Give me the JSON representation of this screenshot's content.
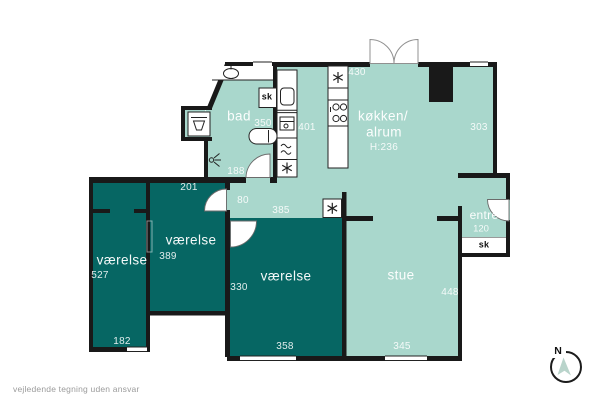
{
  "colors": {
    "room_light": "#a9d7cc",
    "room_dark": "#066663",
    "wall": "#191919",
    "muted_text": "#9b9b9b"
  },
  "rooms": {
    "bad": {
      "name": "bad",
      "closet": "sk",
      "dim_width": "350",
      "dim_bottom": "188"
    },
    "kitchen": {
      "name1": "køkken/",
      "name2": "alrum",
      "ceiling": "H:236",
      "dim_top": "430",
      "dim_left": "401",
      "dim_right": "303"
    },
    "hall": {
      "dim_width": "80",
      "dim_length": "385"
    },
    "entre": {
      "name": "entré",
      "dim_width": "120",
      "closet": "sk"
    },
    "stue": {
      "name": "stue",
      "dim_right": "448",
      "dim_bottom": "345"
    },
    "bedroom_bottom": {
      "name": "værelse",
      "dim_left": "330",
      "dim_bottom": "358"
    },
    "bedroom_mid": {
      "name": "værelse",
      "dim": "389",
      "dim_top": "201"
    },
    "bedroom_left": {
      "name": "værelse",
      "dim": "527",
      "dim_bottom": "182"
    }
  },
  "compass": {
    "label": "N"
  },
  "footer": {
    "disclaimer": "vejledende tegning uden ansvar"
  },
  "icons": {
    "toilet-icon": "ellipse",
    "washbasin-icon": "trapezoid-basin",
    "bathtub-icon": "pill",
    "sink-icon": "rounded-square",
    "cooktop-icon": "four-circles",
    "dishwasher-icon": "waves",
    "freezer-icon": "snowflake",
    "lamp-icon": "ray-fan",
    "compass-arrow-icon": "cursor-triangle"
  }
}
